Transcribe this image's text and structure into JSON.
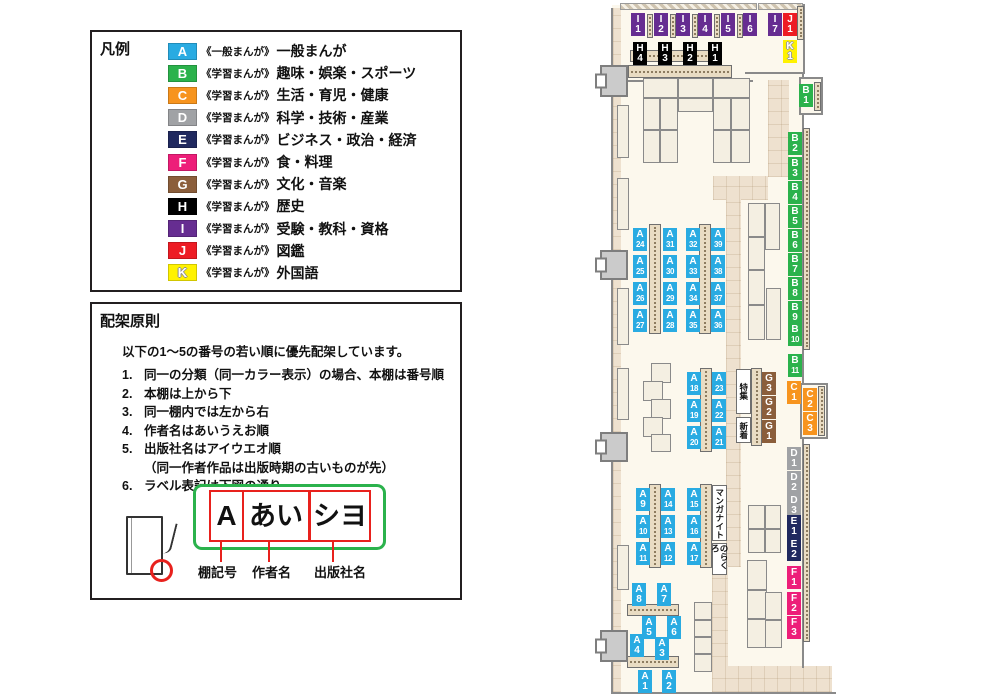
{
  "legend": {
    "title": "凡例",
    "items": [
      {
        "letter": "A",
        "prefix": "《一般まんが》",
        "label": "一般まんが",
        "color": "#29abe2"
      },
      {
        "letter": "B",
        "prefix": "《学習まんが》",
        "label": "趣味・娯楽・スポーツ",
        "color": "#2bb24c"
      },
      {
        "letter": "C",
        "prefix": "《学習まんが》",
        "label": "生活・育児・健康",
        "color": "#f7941e"
      },
      {
        "letter": "D",
        "prefix": "《学習まんが》",
        "label": "科学・技術・産業",
        "color": "#a0a2a5"
      },
      {
        "letter": "E",
        "prefix": "《学習まんが》",
        "label": "ビジネス・政治・経済",
        "color": "#20295f"
      },
      {
        "letter": "F",
        "prefix": "《学習まんが》",
        "label": "食・料理",
        "color": "#ed1e79"
      },
      {
        "letter": "G",
        "prefix": "《学習まんが》",
        "label": "文化・音楽",
        "color": "#8b5e3b"
      },
      {
        "letter": "H",
        "prefix": "《学習まんが》",
        "label": "歴史",
        "color": "#000000"
      },
      {
        "letter": "I",
        "prefix": "《学習まんが》",
        "label": "受験・教科・資格",
        "color": "#662d91"
      },
      {
        "letter": "J",
        "prefix": "《学習まんが》",
        "label": "図鑑",
        "color": "#ed1c24"
      },
      {
        "letter": "K",
        "prefix": "《学習まんが》",
        "label": "外国語",
        "color": "#fff200",
        "outlined": true
      }
    ]
  },
  "rules": {
    "title": "配架原則",
    "intro": "以下の1〜5の番号の若い順に優先配架しています。",
    "items": [
      {
        "num": "1.",
        "text": "同一の分類（同一カラー表示）の場合、本棚は番号順"
      },
      {
        "num": "2.",
        "text": "本棚は上から下"
      },
      {
        "num": "3.",
        "text": "同一棚内では左から右"
      },
      {
        "num": "4.",
        "text": "作者名はあいうえお順"
      },
      {
        "num": "5.",
        "text": "出版社名はアイウエオ順",
        "sub": "（同一作者作品は出版時期の古いものが先）"
      },
      {
        "num": "6.",
        "text": "ラベル表記は下図の通り"
      }
    ],
    "label_example": {
      "boxes": [
        {
          "text": "A",
          "x": 117,
          "y": 186,
          "w": 31,
          "h": 48,
          "fs": 28
        },
        {
          "text": "あい",
          "x": 150,
          "y": 186,
          "w": 64,
          "h": 48,
          "fs": 27
        },
        {
          "text": "シヨ",
          "x": 217,
          "y": 186,
          "w": 58,
          "h": 48,
          "fs": 27
        }
      ],
      "lines": [
        [
          128,
          236,
          22
        ],
        [
          176,
          236,
          22
        ],
        [
          240,
          236,
          22
        ]
      ],
      "captions": [
        {
          "text": "棚記号",
          "x": 106,
          "y": 258
        },
        {
          "text": "作者名",
          "x": 160,
          "y": 258
        },
        {
          "text": "出版社名",
          "x": 222,
          "y": 258
        }
      ]
    }
  },
  "map": {
    "colors": {
      "A": "#29abe2",
      "B": "#2bb24c",
      "C": "#f7941e",
      "D": "#a0a2a5",
      "E": "#20295f",
      "F": "#ed1e79",
      "G": "#8b5e3b",
      "H": "#000000",
      "I": "#662d91",
      "J": "#ed1c24",
      "K": "#fff200"
    },
    "floor": [
      [
        17,
        5,
        191,
        688
      ]
    ],
    "walkways": [
      [
        18,
        8,
        8,
        684
      ],
      [
        173,
        80,
        21,
        97
      ],
      [
        118,
        176,
        55,
        24
      ],
      [
        131,
        199,
        15,
        368
      ],
      [
        117,
        565,
        16,
        105
      ],
      [
        117,
        666,
        120,
        26
      ]
    ],
    "hatch": [
      [
        25,
        3,
        137,
        7
      ],
      [
        163,
        3,
        45,
        7
      ]
    ],
    "walls": [
      [
        16,
        8,
        2,
        686
      ],
      [
        16,
        692,
        225,
        2
      ],
      [
        208,
        4,
        2,
        70
      ],
      [
        150,
        72,
        58,
        2
      ],
      [
        207,
        74,
        2,
        312
      ],
      [
        207,
        438,
        2,
        230
      ],
      [
        33,
        80,
        125,
        2
      ]
    ],
    "alcoves": [
      [
        204,
        77,
        24,
        38
      ],
      [
        205,
        383,
        28,
        56
      ]
    ],
    "strips_v": [
      [
        54,
        224,
        12,
        110
      ],
      [
        104,
        224,
        12,
        110
      ],
      [
        105,
        368,
        12,
        84
      ],
      [
        156,
        368,
        11,
        78
      ],
      [
        54,
        484,
        12,
        84
      ],
      [
        105,
        484,
        12,
        84
      ],
      [
        202,
        6,
        7,
        34
      ],
      [
        219,
        82,
        7,
        29
      ],
      [
        208,
        128,
        7,
        222
      ],
      [
        223,
        386,
        7,
        50
      ],
      [
        208,
        444,
        7,
        198
      ],
      [
        52,
        14,
        6,
        24
      ],
      [
        75,
        14,
        6,
        24
      ],
      [
        97,
        14,
        6,
        24
      ],
      [
        119,
        14,
        6,
        24
      ],
      [
        142,
        14,
        6,
        24
      ]
    ],
    "strips_h": [
      [
        35,
        50,
        92,
        12
      ],
      [
        33,
        65,
        104,
        13
      ],
      [
        32,
        604,
        52,
        12
      ],
      [
        32,
        656,
        52,
        12
      ]
    ],
    "shelves": [
      [
        48,
        78,
        35,
        20
      ],
      [
        83,
        78,
        35,
        20
      ],
      [
        118,
        78,
        37,
        20
      ],
      [
        48,
        98,
        17,
        32
      ],
      [
        65,
        98,
        18,
        32
      ],
      [
        48,
        130,
        17,
        33
      ],
      [
        65,
        130,
        18,
        33
      ],
      [
        118,
        98,
        18,
        32
      ],
      [
        136,
        98,
        19,
        32
      ],
      [
        118,
        130,
        18,
        33
      ],
      [
        136,
        130,
        19,
        33
      ],
      [
        83,
        98,
        35,
        14
      ],
      [
        153,
        203,
        17,
        34
      ],
      [
        153,
        237,
        17,
        33
      ],
      [
        153,
        270,
        17,
        35
      ],
      [
        153,
        305,
        17,
        35
      ],
      [
        170,
        203,
        15,
        47
      ],
      [
        171,
        288,
        15,
        52
      ],
      [
        56,
        363,
        20,
        20
      ],
      [
        48,
        381,
        20,
        20
      ],
      [
        56,
        399,
        20,
        20
      ],
      [
        48,
        417,
        20,
        20
      ],
      [
        56,
        434,
        20,
        18
      ],
      [
        153,
        505,
        17,
        24
      ],
      [
        153,
        529,
        17,
        24
      ],
      [
        170,
        505,
        16,
        24
      ],
      [
        170,
        529,
        16,
        24
      ],
      [
        99,
        602,
        18,
        18
      ],
      [
        99,
        620,
        18,
        17
      ],
      [
        99,
        637,
        18,
        17
      ],
      [
        99,
        654,
        18,
        18
      ],
      [
        152,
        560,
        20,
        30
      ],
      [
        152,
        590,
        20,
        29
      ],
      [
        152,
        619,
        20,
        29
      ],
      [
        170,
        592,
        17,
        28
      ],
      [
        170,
        620,
        17,
        28
      ],
      [
        22,
        105,
        12,
        53
      ],
      [
        22,
        178,
        12,
        52
      ],
      [
        22,
        288,
        12,
        57
      ],
      [
        22,
        368,
        12,
        52
      ],
      [
        22,
        545,
        12,
        45
      ]
    ],
    "doors": [
      [
        5,
        65,
        28,
        32
      ],
      [
        5,
        250,
        28,
        30
      ],
      [
        5,
        432,
        28,
        30
      ],
      [
        5,
        630,
        28,
        32
      ]
    ],
    "labels": [
      {
        "id": "I1",
        "x": 36,
        "y": 13
      },
      {
        "id": "I2",
        "x": 59,
        "y": 13
      },
      {
        "id": "I3",
        "x": 81,
        "y": 13
      },
      {
        "id": "I4",
        "x": 103,
        "y": 13
      },
      {
        "id": "I5",
        "x": 126,
        "y": 13
      },
      {
        "id": "I6",
        "x": 148,
        "y": 13
      },
      {
        "id": "I7",
        "x": 173,
        "y": 13
      },
      {
        "id": "J1",
        "x": 188,
        "y": 13
      },
      {
        "id": "K1",
        "x": 188,
        "y": 40
      },
      {
        "id": "H4",
        "x": 38,
        "y": 42
      },
      {
        "id": "H3",
        "x": 63,
        "y": 42
      },
      {
        "id": "H2",
        "x": 88,
        "y": 42
      },
      {
        "id": "H1",
        "x": 113,
        "y": 42
      },
      {
        "id": "B1",
        "x": 204,
        "y": 84
      },
      {
        "id": "B2",
        "x": 193,
        "y": 132
      },
      {
        "id": "B3",
        "x": 193,
        "y": 157
      },
      {
        "id": "B4",
        "x": 193,
        "y": 181
      },
      {
        "id": "B5",
        "x": 193,
        "y": 205
      },
      {
        "id": "B6",
        "x": 193,
        "y": 229
      },
      {
        "id": "B7",
        "x": 193,
        "y": 253
      },
      {
        "id": "B8",
        "x": 193,
        "y": 277
      },
      {
        "id": "B9",
        "x": 193,
        "y": 301
      },
      {
        "id": "B10",
        "x": 193,
        "y": 323
      },
      {
        "id": "B11",
        "x": 193,
        "y": 354
      },
      {
        "id": "C1",
        "x": 192,
        "y": 381
      },
      {
        "id": "C2",
        "x": 208,
        "y": 388
      },
      {
        "id": "C3",
        "x": 208,
        "y": 412
      },
      {
        "id": "D1",
        "x": 192,
        "y": 447
      },
      {
        "id": "D2",
        "x": 192,
        "y": 471
      },
      {
        "id": "D3",
        "x": 192,
        "y": 494
      },
      {
        "id": "E1",
        "x": 192,
        "y": 515
      },
      {
        "id": "E2",
        "x": 192,
        "y": 538
      },
      {
        "id": "F1",
        "x": 192,
        "y": 566
      },
      {
        "id": "F2",
        "x": 192,
        "y": 592
      },
      {
        "id": "F3",
        "x": 192,
        "y": 616
      },
      {
        "id": "G3",
        "x": 167,
        "y": 372
      },
      {
        "id": "G2",
        "x": 167,
        "y": 396
      },
      {
        "id": "G1",
        "x": 167,
        "y": 420
      },
      {
        "id": "A24",
        "x": 38,
        "y": 228
      },
      {
        "id": "A25",
        "x": 38,
        "y": 255
      },
      {
        "id": "A26",
        "x": 38,
        "y": 282
      },
      {
        "id": "A27",
        "x": 38,
        "y": 309
      },
      {
        "id": "A31",
        "x": 68,
        "y": 228
      },
      {
        "id": "A30",
        "x": 68,
        "y": 255
      },
      {
        "id": "A29",
        "x": 68,
        "y": 282
      },
      {
        "id": "A28",
        "x": 68,
        "y": 309
      },
      {
        "id": "A32",
        "x": 91,
        "y": 228
      },
      {
        "id": "A33",
        "x": 91,
        "y": 255
      },
      {
        "id": "A34",
        "x": 91,
        "y": 282
      },
      {
        "id": "A35",
        "x": 91,
        "y": 309
      },
      {
        "id": "A39",
        "x": 116,
        "y": 228
      },
      {
        "id": "A38",
        "x": 116,
        "y": 255
      },
      {
        "id": "A37",
        "x": 116,
        "y": 282
      },
      {
        "id": "A36",
        "x": 116,
        "y": 309
      },
      {
        "id": "A18",
        "x": 92,
        "y": 372
      },
      {
        "id": "A19",
        "x": 92,
        "y": 399
      },
      {
        "id": "A20",
        "x": 92,
        "y": 426
      },
      {
        "id": "A23",
        "x": 117,
        "y": 372
      },
      {
        "id": "A22",
        "x": 117,
        "y": 399
      },
      {
        "id": "A21",
        "x": 117,
        "y": 426
      },
      {
        "id": "A9",
        "x": 41,
        "y": 488
      },
      {
        "id": "A10",
        "x": 41,
        "y": 515
      },
      {
        "id": "A11",
        "x": 41,
        "y": 542
      },
      {
        "id": "A14",
        "x": 66,
        "y": 488
      },
      {
        "id": "A13",
        "x": 66,
        "y": 515
      },
      {
        "id": "A12",
        "x": 66,
        "y": 542
      },
      {
        "id": "A15",
        "x": 92,
        "y": 488
      },
      {
        "id": "A16",
        "x": 92,
        "y": 515
      },
      {
        "id": "A17",
        "x": 92,
        "y": 542
      },
      {
        "id": "A8",
        "x": 37,
        "y": 583
      },
      {
        "id": "A7",
        "x": 62,
        "y": 583
      },
      {
        "id": "A5",
        "x": 47,
        "y": 616
      },
      {
        "id": "A6",
        "x": 72,
        "y": 616
      },
      {
        "id": "A4",
        "x": 35,
        "y": 634
      },
      {
        "id": "A3",
        "x": 60,
        "y": 637
      },
      {
        "id": "A1",
        "x": 43,
        "y": 670
      },
      {
        "id": "A2",
        "x": 67,
        "y": 670
      }
    ],
    "signs": [
      {
        "text": "特集",
        "x": 141,
        "y": 369,
        "w": 15,
        "h": 45
      },
      {
        "text": "新着",
        "x": 141,
        "y": 417,
        "w": 15,
        "h": 26
      },
      {
        "text": "マンガナイト",
        "x": 117,
        "y": 485,
        "w": 15,
        "h": 56
      },
      {
        "text": "のらくろ",
        "x": 117,
        "y": 543,
        "w": 15,
        "h": 32
      }
    ]
  }
}
